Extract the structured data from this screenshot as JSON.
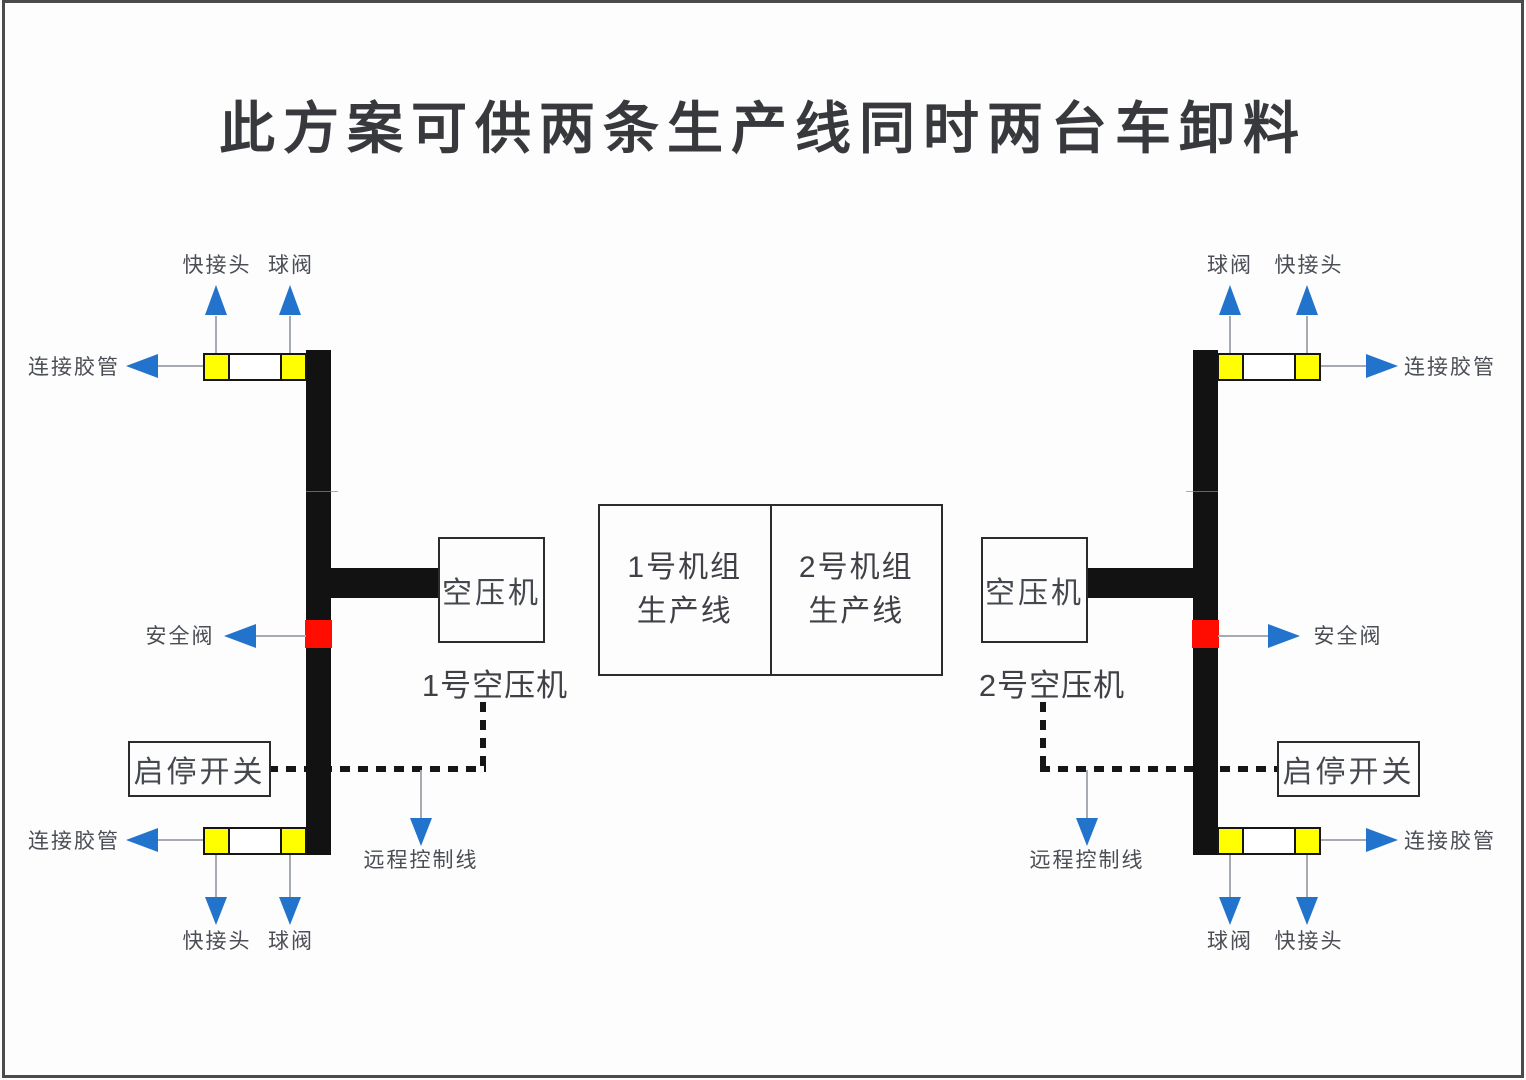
{
  "title": "此方案可供两条生产线同时两台车卸料",
  "labels": {
    "quick_connector": "快接头",
    "ball_valve": "球阀",
    "hose": "连接胶管",
    "safety_valve": "安全阀",
    "switch": "启停开关",
    "remote_line": "远程控制线",
    "compressor": "空压机"
  },
  "left_system": {
    "compressor_name": "1号空压机"
  },
  "right_system": {
    "compressor_name": "2号空压机"
  },
  "production_lines": {
    "unit1": {
      "name": "1号机组",
      "type": "生产线"
    },
    "unit2": {
      "name": "2号机组",
      "type": "生产线"
    }
  },
  "colors": {
    "pipe_black": "#121213",
    "valve_yellow": "#ffff00",
    "safety_valve_red": "#fe0d00",
    "arrow_blue": "#2273cb",
    "text_gray": "#45484e"
  }
}
